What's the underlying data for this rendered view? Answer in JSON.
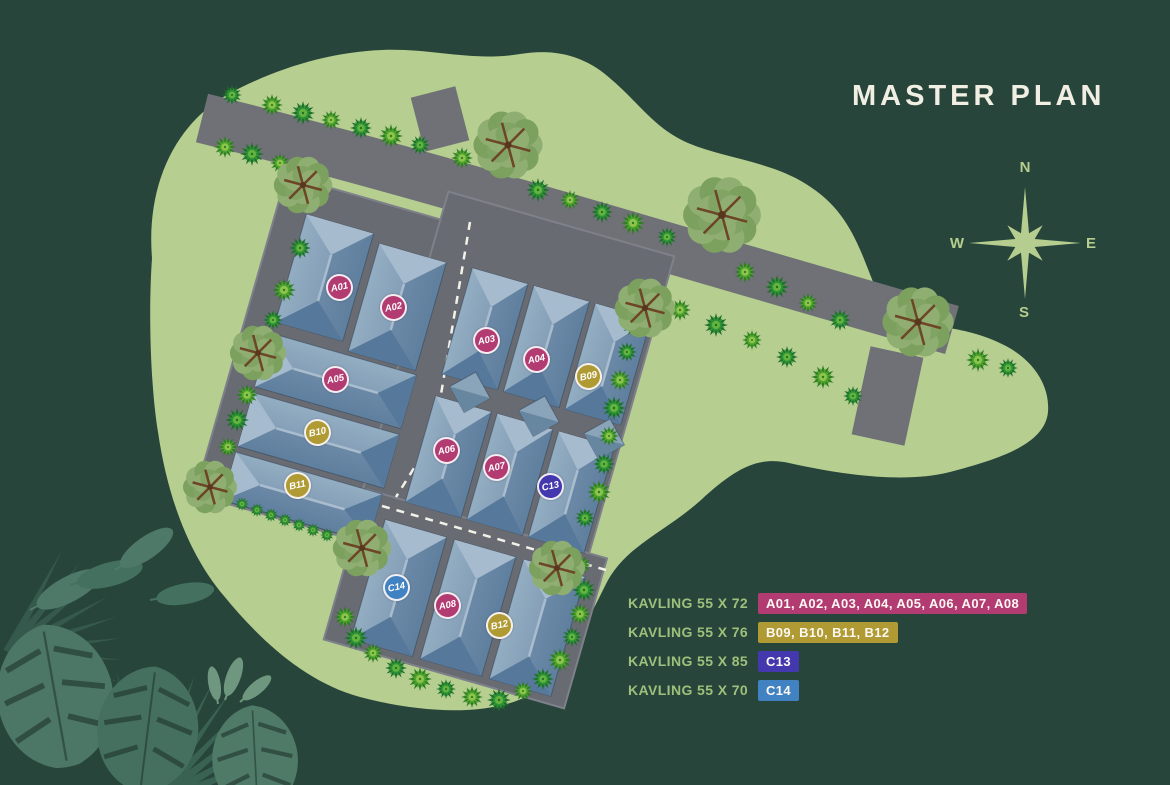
{
  "title": "MASTER PLAN",
  "compass": {
    "n": "N",
    "e": "E",
    "s": "S",
    "w": "W"
  },
  "colors": {
    "background": "#27453a",
    "land": "#b6ce90",
    "road": "#6f7176",
    "pavement": "#696b73",
    "roof_light": "#a6bbcd",
    "roof_dark": "#56789a",
    "category_a": "#b23c72",
    "category_b": "#b09a33",
    "category_c13": "#4338ae",
    "category_c14": "#4182c2"
  },
  "legend": {
    "rows": [
      {
        "label": "KAVLING 55 X 72",
        "plots": "A01, A02, A03, A04, A05, A06, A07, A08",
        "color": "#b23c72"
      },
      {
        "label": "KAVLING 55 X 76",
        "plots": "B09, B10, B11, B12",
        "color": "#b09a33"
      },
      {
        "label": "KAVLING 55 X 85",
        "plots": "C13",
        "color": "#4338ae"
      },
      {
        "label": "KAVLING 55 X 70",
        "plots": "C14",
        "color": "#4182c2"
      }
    ]
  },
  "map": {
    "plots": [
      {
        "id": "A01",
        "color": "#b23c72"
      },
      {
        "id": "A02",
        "color": "#b23c72"
      },
      {
        "id": "A05",
        "color": "#b23c72"
      },
      {
        "id": "B10",
        "color": "#b09a33"
      },
      {
        "id": "B11",
        "color": "#b09a33"
      },
      {
        "id": "A03",
        "color": "#b23c72"
      },
      {
        "id": "A04",
        "color": "#b23c72"
      },
      {
        "id": "B09",
        "color": "#b09a33"
      },
      {
        "id": "A06",
        "color": "#b23c72"
      },
      {
        "id": "A07",
        "color": "#b23c72"
      },
      {
        "id": "C13",
        "color": "#4338ae"
      },
      {
        "id": "C14",
        "color": "#4182c2"
      },
      {
        "id": "A08",
        "color": "#b23c72"
      },
      {
        "id": "B12",
        "color": "#b09a33"
      }
    ]
  }
}
